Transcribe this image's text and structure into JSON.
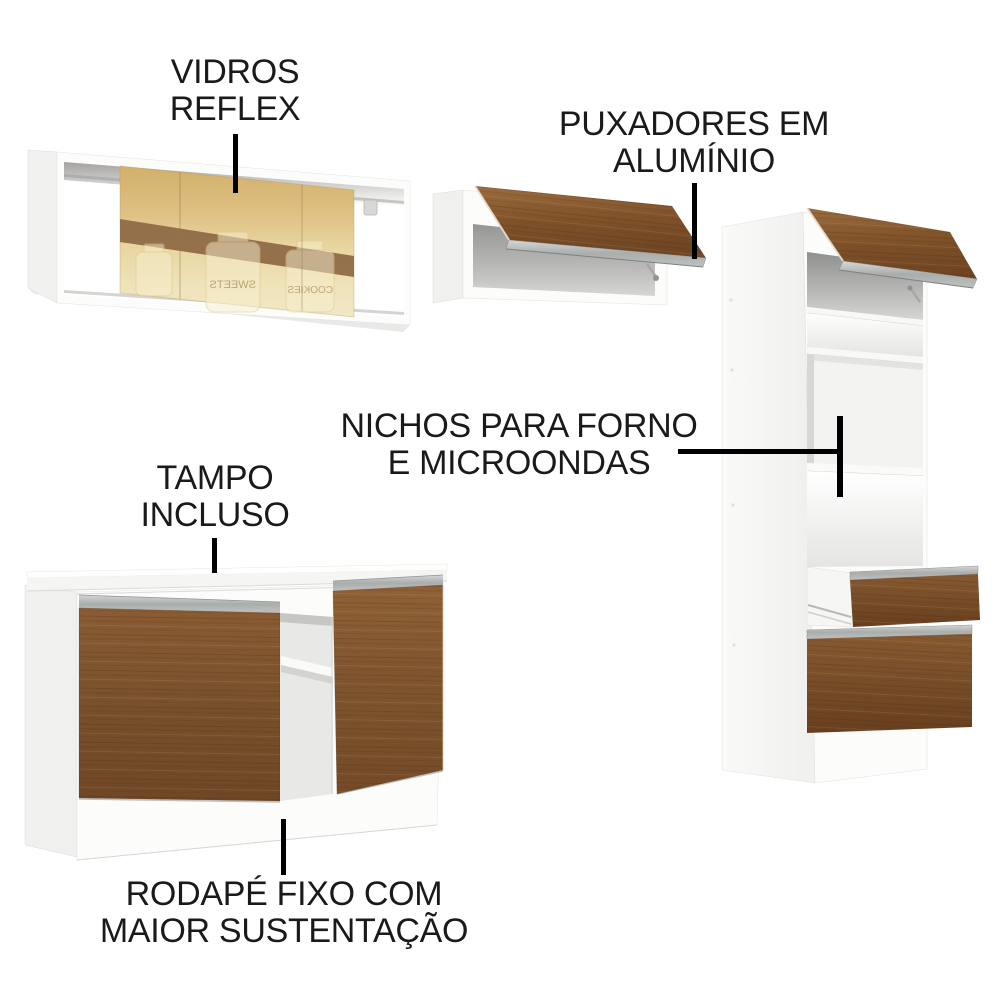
{
  "background": "#ffffff",
  "callouts": {
    "vidros": {
      "line1": "VIDROS",
      "line2": "REFLEX"
    },
    "puxadores": {
      "line1": "PUXADORES EM",
      "line2": "ALUMÍNIO"
    },
    "nichos": {
      "line1": "NICHOS PARA FORNO",
      "line2": "E MICROONDAS"
    },
    "tampo": {
      "line1": "TAMPO",
      "line2": "INCLUSO"
    },
    "rodape": {
      "line1": "RODAPÉ FIXO COM",
      "line2": "MAIOR SUSTENTAÇÃO"
    }
  },
  "glass_reflections": [
    "SWEETS",
    "COOKIES"
  ],
  "components": [
    "glass-wall-cabinet",
    "flip-door-wall-cabinet",
    "oven-tower-cabinet",
    "base-cabinet-with-countertop"
  ],
  "colors": {
    "label_text": "#1a1a1a",
    "pointer_line": "#000000",
    "wood_brown": "#7a4f2b",
    "wood_light": "#8f6136",
    "aluminum_gray": "#aeb2b1",
    "cabinet_white": "#fcfcfa",
    "interior_gray": "#9e9e9c",
    "glass_gold": "#d9ba79",
    "glass_cream": "#efe3b9",
    "glass_shelf_band": "#8c6843"
  }
}
